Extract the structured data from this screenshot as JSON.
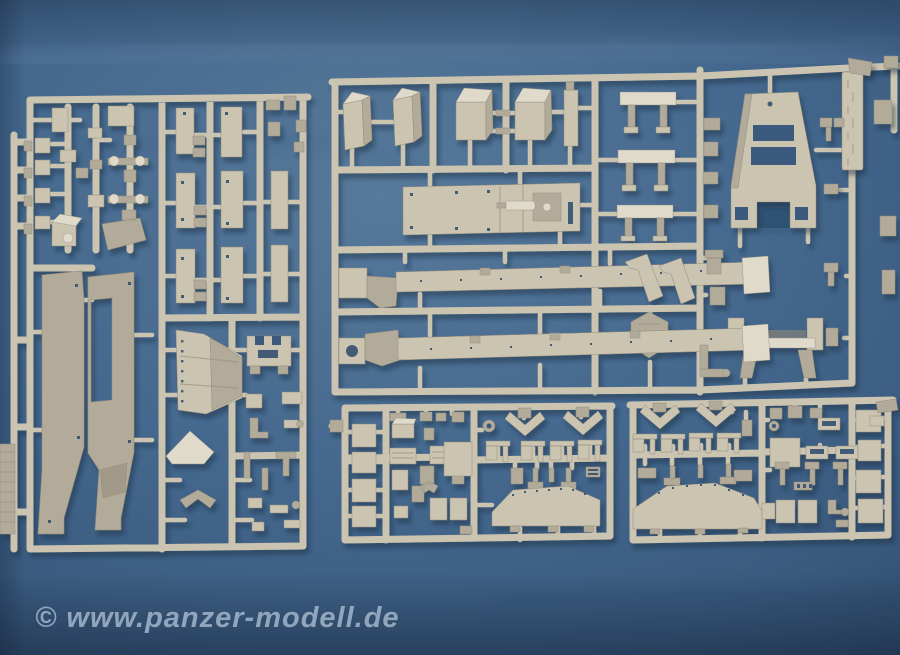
{
  "meta": {
    "type": "photograph",
    "subject": "Light-tan injection-moulded model kit sprues laid out on a blue paper backdrop",
    "visible_sprues": 4
  },
  "watermark": {
    "text": "© www.panzer-modell.de"
  },
  "palette": {
    "bg-light": "#57799a",
    "bg-base": "#45688e",
    "bg-dark": "#3a5a7e",
    "bg-edge": "#2e4a68",
    "sprue-light": "#e0dacb",
    "sprue-base": "#cbc4b1",
    "sprue-mid": "#b3ab99",
    "sprue-dark": "#948c7a",
    "hole-dark": "#33506e",
    "shadow": "#16293f",
    "watermark": "#9fb3c8"
  },
  "sprues": [
    {
      "id": "left",
      "description": "Large sprue with paired flat plates, two long hull side panels, fender bracket and many small fittings"
    },
    {
      "id": "top-center",
      "description": "Large sprue with stowage boxes, bench panels, engine deck plate and two long chassis frame rails"
    },
    {
      "id": "top-right",
      "description": "Right section of top sprue with trapezoid gantry frame, channel bracket and embossed runner tag"
    },
    {
      "id": "bottom-left",
      "description": "Detail sprue with square plates, V-braces, small brackets and angled hull plate"
    },
    {
      "id": "bottom-right",
      "description": "Matching detail sprue with V-braces, slotted plates, small brackets and angled hull plate"
    }
  ]
}
